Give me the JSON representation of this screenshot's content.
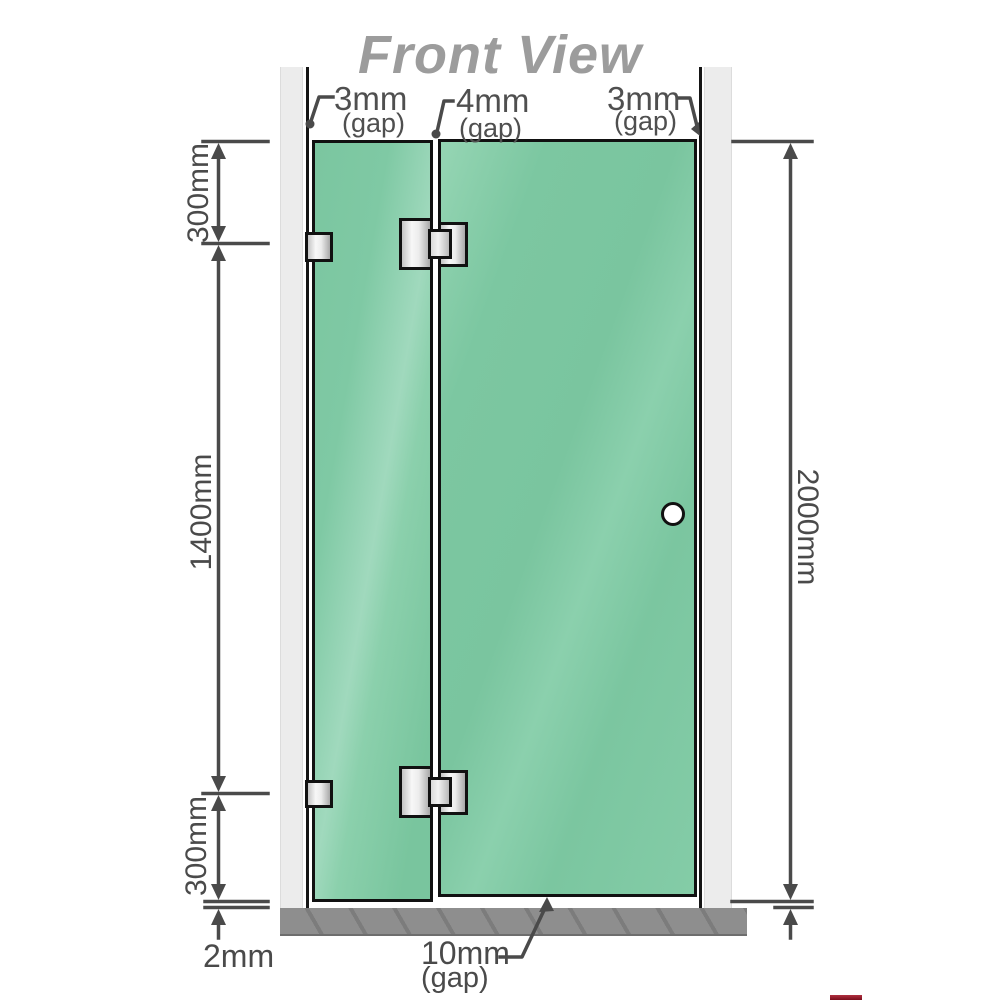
{
  "title": "Front View",
  "colors": {
    "glass_green": "#7cc7a1",
    "glass_highlight": "#a0d9bd",
    "wall_gray": "#ececec",
    "floor_gray": "#8e8e8e",
    "outline_black": "#111111",
    "dimension_gray": "#4a4a4a",
    "title_gray": "#9c9c9c",
    "logo_red": "#8c1622"
  },
  "gap_labels": {
    "top_left": {
      "value": "3mm",
      "note": "(gap)"
    },
    "top_middle": {
      "value": "4mm",
      "note": "(gap)"
    },
    "top_right": {
      "value": "3mm",
      "note": "(gap)"
    },
    "bottom_door": {
      "value": "10mm",
      "note": "(gap)"
    },
    "bottom_floor": {
      "value": "2mm"
    }
  },
  "dimensions": {
    "left_top": "300mm",
    "left_middle": "1400mm",
    "left_bottom": "300mm",
    "right_full": "2000mm"
  }
}
